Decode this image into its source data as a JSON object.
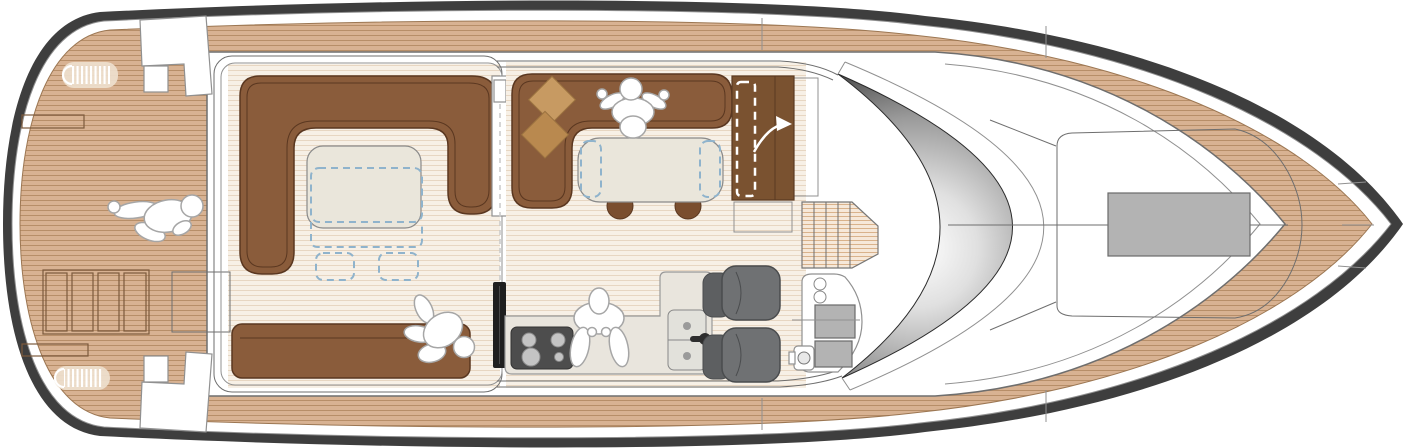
{
  "diagram": {
    "type": "yacht-main-deck-floor-plan",
    "view": "top-down",
    "orientation": "bow-right-stern-left",
    "text_labels": []
  },
  "colors": {
    "hull": "#3e3e3e",
    "line": "#6e6e6e",
    "line_soft": "#909090",
    "teak": "#d8b292",
    "teak_line": "#b78e68",
    "teak_edge": "#9c7753",
    "floor": "#f7f0e6",
    "floor_line": "#e7d6c2",
    "pale": "#f6e8d9",
    "pale_line": "#d9b28b",
    "sofa": "#8a5c3b",
    "sofa_seam": "#5a3720",
    "door_wood": "#7a5230",
    "cushion1": "#c79a62",
    "cushion2": "#b9894f",
    "table": "#eae6db",
    "dash_blue": "#8fb3cc",
    "door_panel": "#1f1f1f",
    "stove": "#4d4d4d",
    "burner": "#c4c4c4",
    "seat": "#6f7173",
    "seat_back": "#5d5f61",
    "counter": "#e9e5dd",
    "sink": "#e2e1db",
    "hatch": "#b3b3b3",
    "hatch_line": "#7c5a3c",
    "cleat": "#eedfce",
    "people_stroke": "#a6a6a6",
    "glass_dark": "#1d1d1d",
    "glass_mid": "#9a9a9a",
    "glass_light": "#ffffff",
    "stool": "#7a4e2f"
  },
  "areas": [
    {
      "id": "swim-aft-deck",
      "name": "aft teak deck"
    },
    {
      "id": "cockpit",
      "name": "cockpit lounge"
    },
    {
      "id": "saloon",
      "name": "saloon and galley"
    },
    {
      "id": "helm",
      "name": "helm station"
    },
    {
      "id": "foredeck",
      "name": "foredeck"
    }
  ],
  "furniture": [
    {
      "id": "cockpit-u-sofa",
      "name": "U-shaped sofa"
    },
    {
      "id": "cockpit-bench",
      "name": "aft bench"
    },
    {
      "id": "cockpit-table",
      "name": "cockpit table with folding extension"
    },
    {
      "id": "saloon-l-sofa",
      "name": "L-shaped saloon sofa"
    },
    {
      "id": "saloon-table",
      "name": "dining table with folding leaves"
    },
    {
      "id": "saloon-stools",
      "name": "two stools"
    },
    {
      "id": "galley-stove",
      "name": "four-burner cooktop"
    },
    {
      "id": "galley-sink",
      "name": "double sink"
    },
    {
      "id": "helm-seats",
      "name": "two helm seats"
    },
    {
      "id": "companionway",
      "name": "stairs below"
    },
    {
      "id": "bow-hatch",
      "name": "foredeck hatch"
    }
  ],
  "people": [
    {
      "location": "aft-deck"
    },
    {
      "location": "cockpit-bench"
    },
    {
      "location": "saloon-table"
    },
    {
      "location": "galley"
    }
  ]
}
